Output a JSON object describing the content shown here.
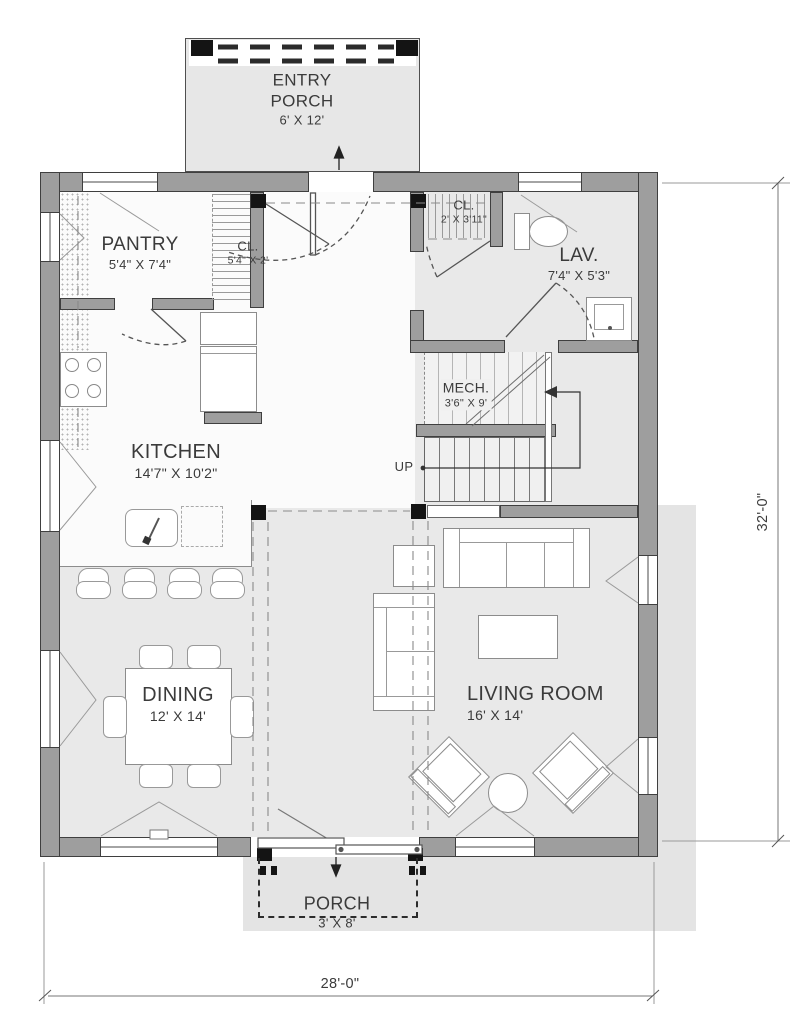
{
  "rooms": [
    {
      "id": "entry-porch",
      "name": "ENTRY PORCH",
      "dims": "6' X 12'"
    },
    {
      "id": "pantry",
      "name": "PANTRY",
      "dims": "5'4\" X 7'4\""
    },
    {
      "id": "closet-pantry",
      "name": "CL.",
      "dims": "5'4\" X 2'"
    },
    {
      "id": "closet-entry",
      "name": "CL.",
      "dims": "2' X 3'11\""
    },
    {
      "id": "lavatory",
      "name": "LAV.",
      "dims": "7'4\" X 5'3\""
    },
    {
      "id": "mechanical",
      "name": "MECH.",
      "dims": "3'6\" X 9'"
    },
    {
      "id": "kitchen",
      "name": "KITCHEN",
      "dims": "14'7\" X 10'2\""
    },
    {
      "id": "dining",
      "name": "DINING",
      "dims": "12' X 14'"
    },
    {
      "id": "living-room",
      "name": "LIVING ROOM",
      "dims": "16' X 14'"
    },
    {
      "id": "porch",
      "name": "PORCH",
      "dims": "3' X 8'"
    }
  ],
  "annotations": {
    "stairs": "UP"
  },
  "overall_dimensions": {
    "width": "28'-0\"",
    "height": "32'-0\""
  },
  "colors": {
    "wall": "#9e9e9e",
    "wall_outline": "#3f3f3f",
    "floor_light": "#fbfbfb",
    "floor_gray": "#e9e9e9",
    "exterior_deck": "#e4e4e4",
    "column": "#141414",
    "text": "#3b3b3b"
  }
}
